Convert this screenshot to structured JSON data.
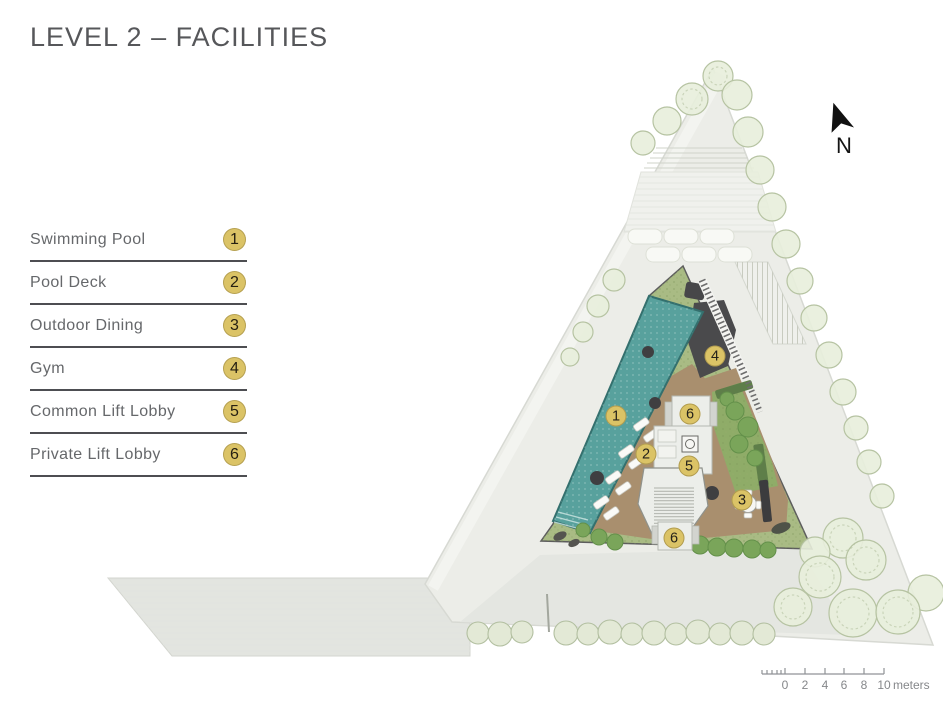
{
  "title": "LEVEL 2 – FACILITIES",
  "legend": {
    "items": [
      {
        "label": "Swimming Pool",
        "number": "1"
      },
      {
        "label": "Pool Deck",
        "number": "2"
      },
      {
        "label": "Outdoor Dining",
        "number": "3"
      },
      {
        "label": "Gym",
        "number": "4"
      },
      {
        "label": "Common Lift Lobby",
        "number": "5"
      },
      {
        "label": "Private Lift Lobby",
        "number": "6"
      }
    ]
  },
  "plan": {
    "north_label": "N",
    "markers": [
      {
        "number": "1",
        "facility": "Swimming Pool"
      },
      {
        "number": "2",
        "facility": "Pool Deck"
      },
      {
        "number": "3",
        "facility": "Outdoor Dining"
      },
      {
        "number": "4",
        "facility": "Gym"
      },
      {
        "number": "5",
        "facility": "Common Lift Lobby"
      },
      {
        "number": "6",
        "facility": "Private Lift Lobby"
      },
      {
        "number": "6",
        "facility": "Private Lift Lobby"
      }
    ],
    "colors": {
      "pool": "#58a19d",
      "deck": "#a98f6e",
      "gym": "#4a4a4c",
      "garden": "#8fac68",
      "landscape": "#a9bb84",
      "marker": "#dbc366",
      "site": "#ecede8"
    }
  },
  "scale_bar": {
    "tick_labels": [
      "0",
      "2",
      "4",
      "6",
      "8",
      "10"
    ],
    "unit_label": "meters"
  }
}
